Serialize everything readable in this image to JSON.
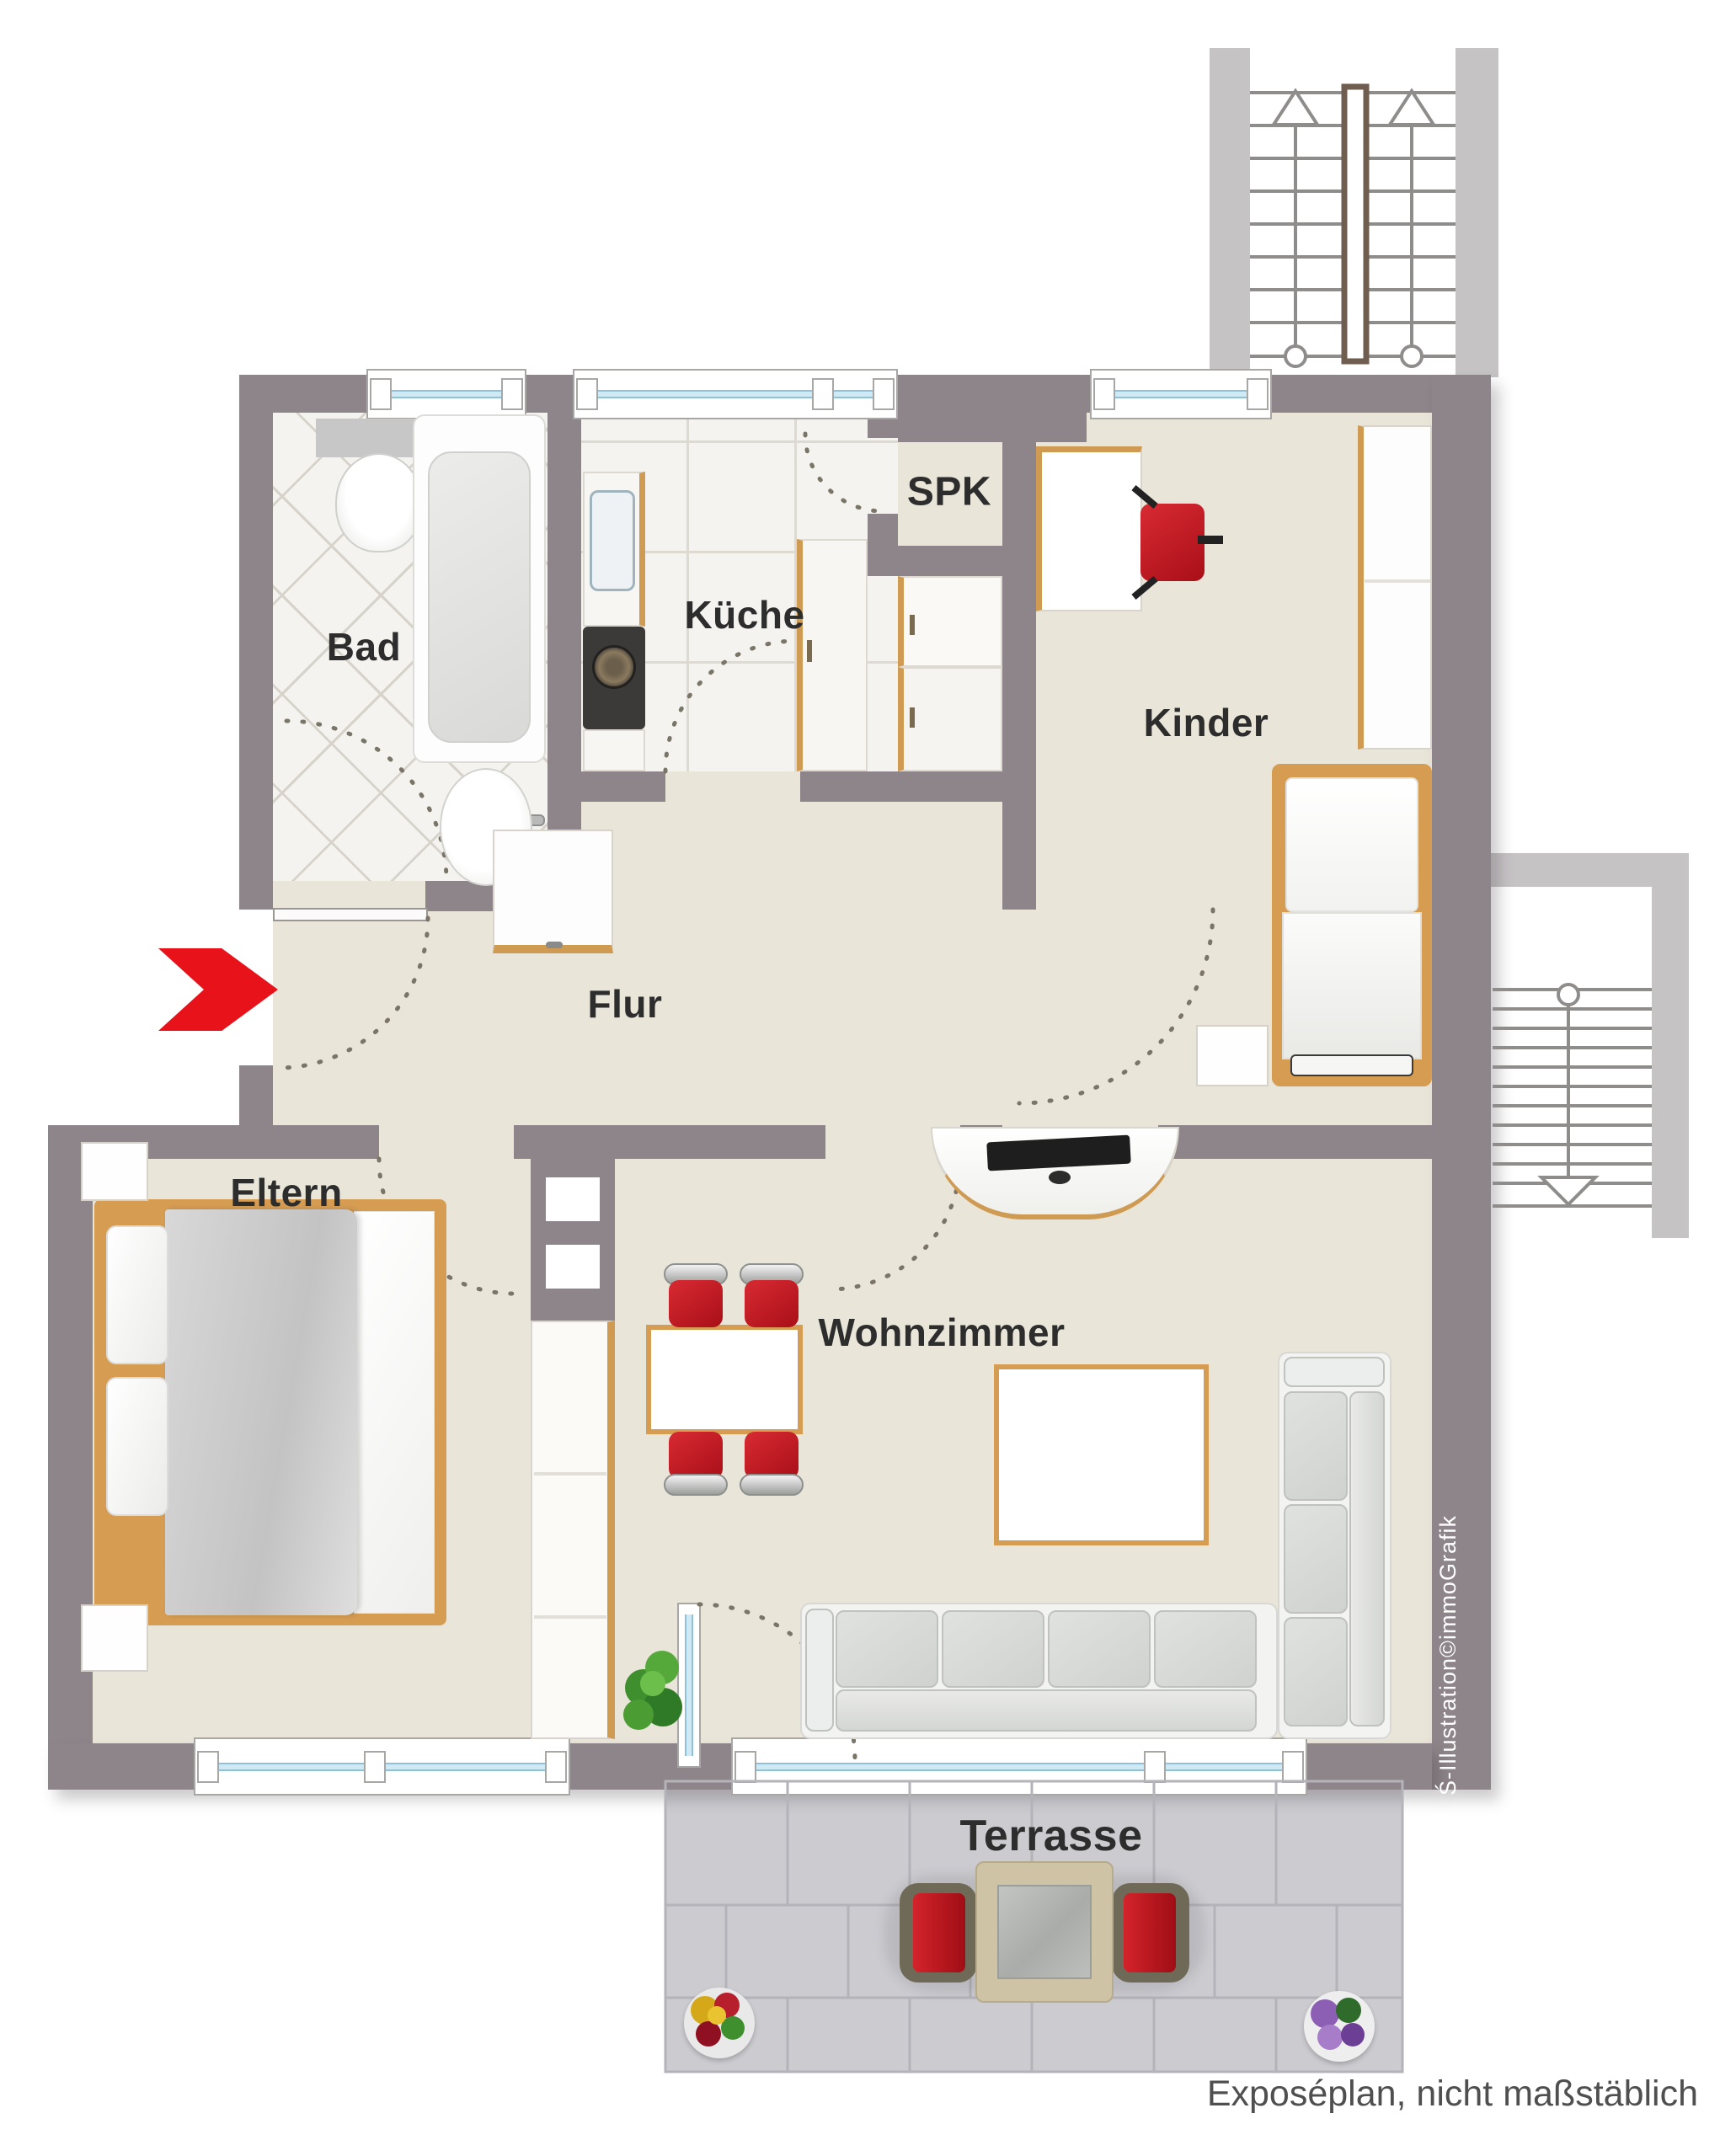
{
  "rooms": [
    {
      "id": "bad",
      "label": "Bad"
    },
    {
      "id": "kueche",
      "label": "Küche"
    },
    {
      "id": "spk",
      "label": "SPK"
    },
    {
      "id": "kinder",
      "label": "Kinder"
    },
    {
      "id": "flur",
      "label": "Flur"
    },
    {
      "id": "eltern",
      "label": "Eltern"
    },
    {
      "id": "wohnzimmer",
      "label": "Wohnzimmer"
    },
    {
      "id": "terrasse",
      "label": "Terrasse"
    }
  ],
  "annotations": {
    "watermark": "Ś-Illustration©immoGrafik",
    "footer": "Exposéplan, nicht maßstäblich"
  },
  "colors": {
    "wall": "#8d858a",
    "wall_light": "#c6c3c5",
    "floor": "#e9e5d9",
    "tile": "#f4f3f0",
    "terrace": "#cbcbd0",
    "glass": "#cfe9f5",
    "accent_red": "#e8121a",
    "wood": "#d59c52",
    "chair_red": "#c32030",
    "sofa": "#d9dbd8",
    "text": "#2d2d2d",
    "watermark": "#ffffff",
    "footer_text": "#4f4f4f"
  }
}
